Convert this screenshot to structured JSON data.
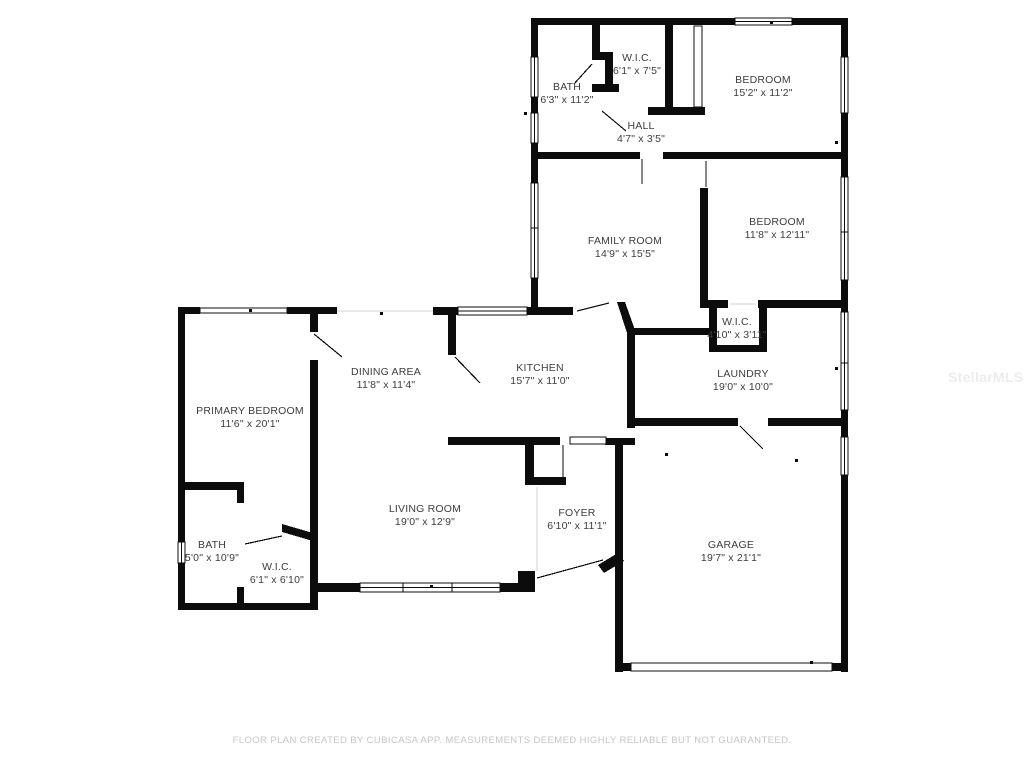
{
  "floor_plan": {
    "rooms": [
      {
        "id": "bath-1",
        "name": "BATH",
        "dims": "6'3\" x 11'2\""
      },
      {
        "id": "wic-1",
        "name": "W.I.C.",
        "dims": "6'1\" x 7'5\""
      },
      {
        "id": "bedroom-1",
        "name": "BEDROOM",
        "dims": "15'2\" x 11'2\""
      },
      {
        "id": "hall",
        "name": "HALL",
        "dims": "4'7\" x 3'5\""
      },
      {
        "id": "family-room",
        "name": "FAMILY ROOM",
        "dims": "14'9\" x 15'5\""
      },
      {
        "id": "bedroom-2",
        "name": "BEDROOM",
        "dims": "11'8\" x 12'11\""
      },
      {
        "id": "wic-2",
        "name": "W.I.C.",
        "dims": "4'10\" x 3'11\""
      },
      {
        "id": "laundry",
        "name": "LAUNDRY",
        "dims": "19'0\" x 10'0\""
      },
      {
        "id": "dining-area",
        "name": "DINING AREA",
        "dims": "11'8\" x 11'4\""
      },
      {
        "id": "kitchen",
        "name": "KITCHEN",
        "dims": "15'7\" x 11'0\""
      },
      {
        "id": "primary-bedroom",
        "name": "PRIMARY BEDROOM",
        "dims": "11'6\" x 20'1\""
      },
      {
        "id": "bath-2",
        "name": "BATH",
        "dims": "5'0\" x 10'9\""
      },
      {
        "id": "wic-3",
        "name": "W.I.C.",
        "dims": "6'1\" x 6'10\""
      },
      {
        "id": "living-room",
        "name": "LIVING ROOM",
        "dims": "19'0\" x 12'9\""
      },
      {
        "id": "foyer",
        "name": "FOYER",
        "dims": "6'10\" x 11'1\""
      },
      {
        "id": "garage",
        "name": "GARAGE",
        "dims": "19'7\" x 21'1\""
      }
    ],
    "disclaimer": "FLOOR PLAN CREATED BY CUBICASA APP. MEASUREMENTS DEEMED HIGHLY RELIABLE BUT NOT GUARANTEED.",
    "watermark": "StellarMLS",
    "colors": {
      "wall": "#0c0c0c",
      "label": "#3d3d3d",
      "disclaimer": "#c6c6c6",
      "background": "#ffffff"
    }
  }
}
